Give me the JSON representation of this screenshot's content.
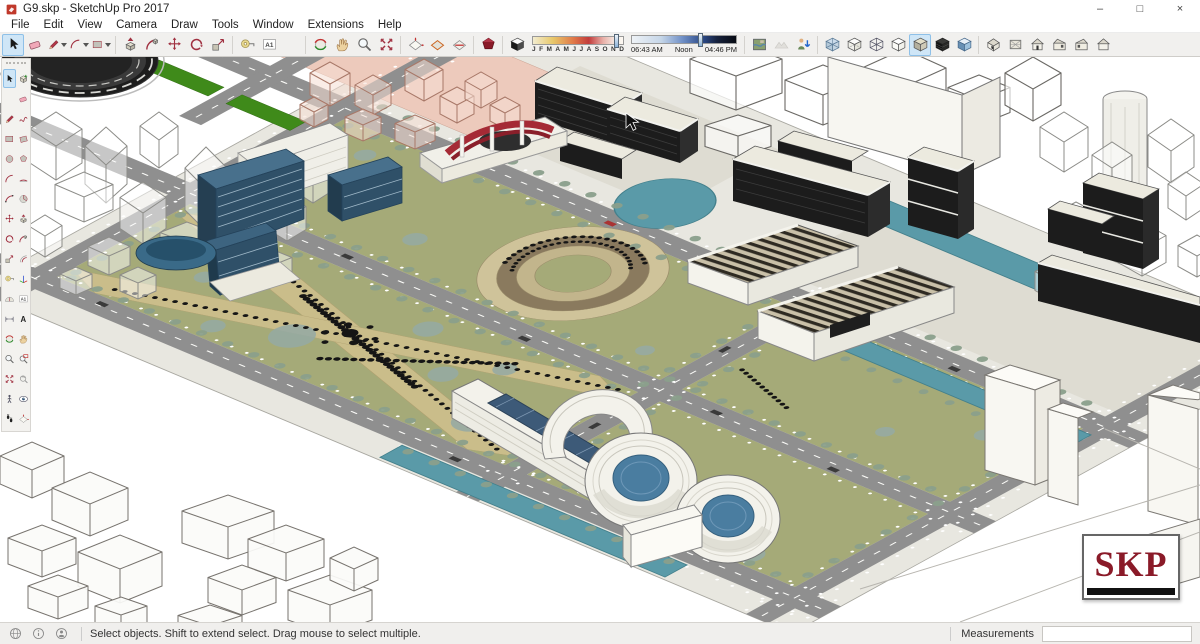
{
  "window": {
    "title": "G9.skp - SketchUp Pro 2017",
    "controls": {
      "minimize": "–",
      "maximize": "□",
      "close": "×"
    }
  },
  "menu": {
    "items": [
      "File",
      "Edit",
      "View",
      "Camera",
      "Draw",
      "Tools",
      "Window",
      "Extensions",
      "Help"
    ]
  },
  "toolbar": {
    "groups_left": [
      {
        "name": "principal",
        "items": [
          {
            "name": "select",
            "icon": "cursor",
            "active": true
          },
          {
            "name": "eraser",
            "icon": "eraser"
          },
          {
            "name": "line",
            "icon": "pencil",
            "dropdown": true
          },
          {
            "name": "arc",
            "icon": "arc",
            "dropdown": true
          },
          {
            "name": "rectangle",
            "icon": "rect",
            "dropdown": true
          }
        ]
      },
      {
        "name": "edit",
        "items": [
          {
            "name": "push-pull",
            "icon": "pushpull"
          },
          {
            "name": "follow-me",
            "icon": "followme"
          },
          {
            "name": "move",
            "icon": "move"
          },
          {
            "name": "rotate",
            "icon": "rotate"
          },
          {
            "name": "scale",
            "icon": "scale"
          }
        ]
      },
      {
        "name": "construction",
        "items": [
          {
            "name": "tape-measure",
            "icon": "tape"
          },
          {
            "name": "text",
            "icon": "text"
          },
          {
            "name": "paint-bucket",
            "icon": "bucket"
          }
        ]
      },
      {
        "name": "camera",
        "items": [
          {
            "name": "orbit",
            "icon": "orbit"
          },
          {
            "name": "pan",
            "icon": "pan"
          },
          {
            "name": "zoom",
            "icon": "zoom"
          },
          {
            "name": "zoom-extents",
            "icon": "zoomext"
          }
        ]
      },
      {
        "name": "section",
        "items": [
          {
            "name": "section-plane",
            "icon": "section"
          },
          {
            "name": "section-display",
            "icon": "section2"
          },
          {
            "name": "section-cuts",
            "icon": "section3"
          }
        ]
      },
      {
        "name": "warehouse",
        "items": [
          {
            "name": "warehouse",
            "icon": "redgem"
          }
        ]
      },
      {
        "name": "shadow-toggle",
        "items": [
          {
            "name": "toggle-shadows",
            "icon": "shcube"
          }
        ]
      }
    ],
    "groups_right": [
      {
        "name": "location",
        "items": [
          {
            "name": "add-location",
            "icon": "map"
          },
          {
            "name": "toggle-terrain",
            "icon": "terrain",
            "disabled": true
          },
          {
            "name": "photo-textures",
            "icon": "phototex"
          }
        ]
      },
      {
        "name": "styles",
        "items": [
          {
            "name": "x-ray",
            "icon": "xray"
          },
          {
            "name": "back-edges",
            "icon": "backedge"
          },
          {
            "name": "wireframe",
            "icon": "wirecube"
          },
          {
            "name": "hidden-line",
            "icon": "hidden"
          },
          {
            "name": "shaded",
            "icon": "shaded",
            "active": true
          },
          {
            "name": "shaded-with-textures",
            "icon": "shadedtex"
          },
          {
            "name": "monochrome",
            "icon": "mono"
          }
        ]
      },
      {
        "name": "views",
        "items": [
          {
            "name": "iso-view",
            "icon": "h-iso"
          },
          {
            "name": "top-view",
            "icon": "h-top"
          },
          {
            "name": "front-view",
            "icon": "h-front"
          },
          {
            "name": "right-view",
            "icon": "h-right"
          },
          {
            "name": "left-view",
            "icon": "h-left"
          },
          {
            "name": "back-view",
            "icon": "h-back"
          }
        ]
      }
    ],
    "shadows": {
      "months": [
        "J",
        "F",
        "M",
        "A",
        "M",
        "J",
        "J",
        "A",
        "S",
        "O",
        "N",
        "D"
      ],
      "sunrise": "06:43 AM",
      "noon": "Noon",
      "sunset": "04:46 PM",
      "date_pct": 90,
      "time_pct": 63
    }
  },
  "palette": {
    "rows": [
      [
        {
          "name": "select",
          "icon": "cursor",
          "active": true
        },
        {
          "name": "make-component",
          "icon": "component"
        }
      ],
      [
        {
          "name": "paint-bucket",
          "icon": "bucket"
        },
        {
          "name": "eraser",
          "icon": "eraser"
        }
      ],
      [
        {
          "name": "line",
          "icon": "pencil"
        },
        {
          "name": "freehand",
          "icon": "freehand"
        }
      ],
      [
        {
          "name": "rectangle",
          "icon": "rect"
        },
        {
          "name": "rotated-rectangle",
          "icon": "rotrect"
        }
      ],
      [
        {
          "name": "circle",
          "icon": "circle"
        },
        {
          "name": "polygon",
          "icon": "polygon"
        }
      ],
      [
        {
          "name": "arc",
          "icon": "arc"
        },
        {
          "name": "two-point-arc",
          "icon": "arc2"
        }
      ],
      [
        {
          "name": "three-point-arc",
          "icon": "arc3"
        },
        {
          "name": "pie",
          "icon": "pie"
        }
      ],
      [
        {
          "name": "move",
          "icon": "move"
        },
        {
          "name": "push-pull",
          "icon": "pushpull"
        }
      ],
      [
        {
          "name": "rotate",
          "icon": "rotate"
        },
        {
          "name": "follow-me",
          "icon": "followme"
        }
      ],
      [
        {
          "name": "scale",
          "icon": "scale"
        },
        {
          "name": "offset",
          "icon": "offset"
        }
      ],
      [
        {
          "name": "tape-measure",
          "icon": "tape"
        },
        {
          "name": "axes",
          "icon": "axes"
        }
      ],
      [
        {
          "name": "protractor",
          "icon": "protractor"
        },
        {
          "name": "text",
          "icon": "text"
        }
      ],
      [
        {
          "name": "dimension",
          "icon": "dim"
        },
        {
          "name": "3d-text",
          "icon": "text3d"
        }
      ],
      [
        {
          "name": "orbit",
          "icon": "orbit"
        },
        {
          "name": "pan",
          "icon": "pan"
        }
      ],
      [
        {
          "name": "zoom",
          "icon": "zoom"
        },
        {
          "name": "zoom-window",
          "icon": "zoomwin"
        }
      ],
      [
        {
          "name": "zoom-extents",
          "icon": "zoomext"
        },
        {
          "name": "previous",
          "icon": "prev"
        }
      ],
      [
        {
          "name": "position-camera",
          "icon": "poscam"
        },
        {
          "name": "look-around",
          "icon": "look"
        }
      ],
      [
        {
          "name": "walk",
          "icon": "walk"
        },
        {
          "name": "section-plane",
          "icon": "section"
        }
      ]
    ]
  },
  "statusbar": {
    "message": "Select objects. Shift to extend select. Drag mouse to select multiple.",
    "measurements_label": "Measurements",
    "measurements_value": ""
  },
  "watermark": {
    "text": "SKP"
  },
  "colors": {
    "selection_highlight": "#cfe6f7",
    "lawn": "#a5aa78",
    "path_tan": "#cabd8a",
    "water": "#5a9aa8",
    "road": "#8f8f8f",
    "plateau": "#e8e7e0",
    "glass_blue": "#2f5068",
    "dark_building": "#1c1c1c",
    "pink_district": "#edcabc",
    "green_median": "#3f8a1a",
    "skp_red": "#8a1a28"
  }
}
